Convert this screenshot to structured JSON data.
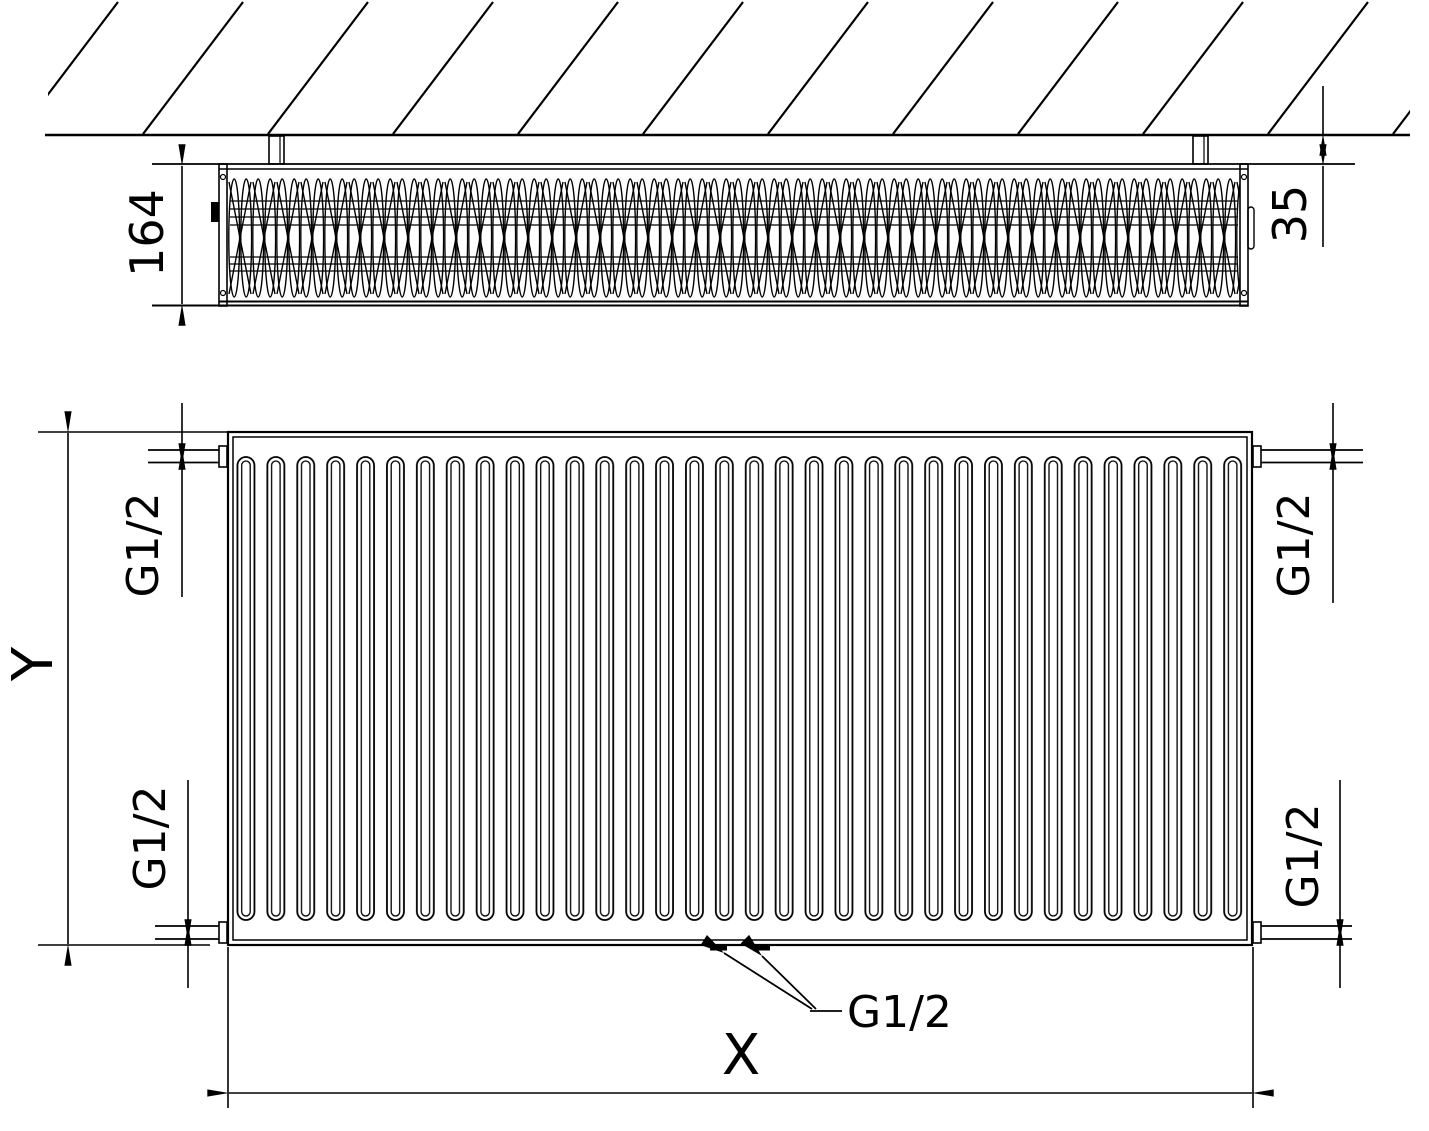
{
  "drawing": {
    "background_color": "#ffffff",
    "line_color": "#000000",
    "top_view": {
      "depth_dimension": "164",
      "wall_clearance_dimension": "35"
    },
    "front_view": {
      "height_dimension": "Y",
      "width_dimension": "X",
      "connection_top_left": "G1/2",
      "connection_top_right": "G1/2",
      "connection_bottom_left": "G1/2",
      "connection_bottom_right": "G1/2",
      "connection_bottom_center": "G1/2"
    }
  }
}
